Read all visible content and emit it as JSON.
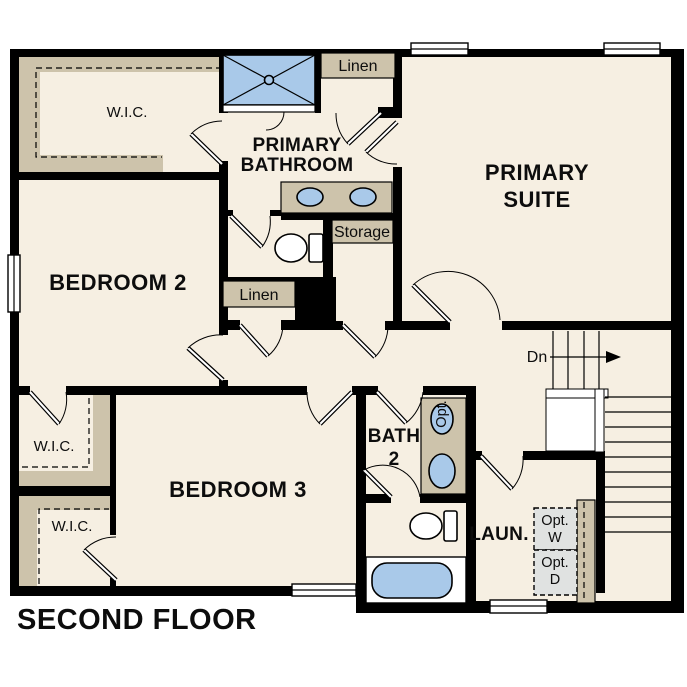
{
  "title": "SECOND FLOOR",
  "rooms": {
    "primary_suite": {
      "line1": "PRIMARY",
      "line2": "SUITE"
    },
    "primary_bathroom": {
      "line1": "PRIMARY",
      "line2": "BATHROOM"
    },
    "bedroom2": {
      "label": "BEDROOM 2"
    },
    "bedroom3": {
      "label": "BEDROOM 3"
    },
    "bath2": {
      "line1": "BATH",
      "line2": "2"
    },
    "laundry": {
      "label": "LAUN."
    }
  },
  "closets": {
    "wic_primary": {
      "label": "W.I.C."
    },
    "wic_mid": {
      "label": "W.I.C."
    },
    "wic_lower": {
      "label": "W.I.C."
    },
    "linen_upper": {
      "label": "Linen"
    },
    "linen_hall": {
      "label": "Linen"
    },
    "storage": {
      "label": "Storage"
    }
  },
  "appliances": {
    "washer": {
      "line1": "Opt.",
      "line2": "W"
    },
    "dryer": {
      "line1": "Opt.",
      "line2": "D"
    },
    "optional_sink": {
      "label": "Opt."
    }
  },
  "stairs": {
    "down": "Dn"
  },
  "colors": {
    "floor": "#f6efe2",
    "wall": "#000000",
    "cabinetry": "#cdc3ab",
    "fixture_blue": "#a9c9e9",
    "appliance_gray": "#e0e2e1",
    "window": "#ffffff",
    "background": "#ffffff"
  }
}
